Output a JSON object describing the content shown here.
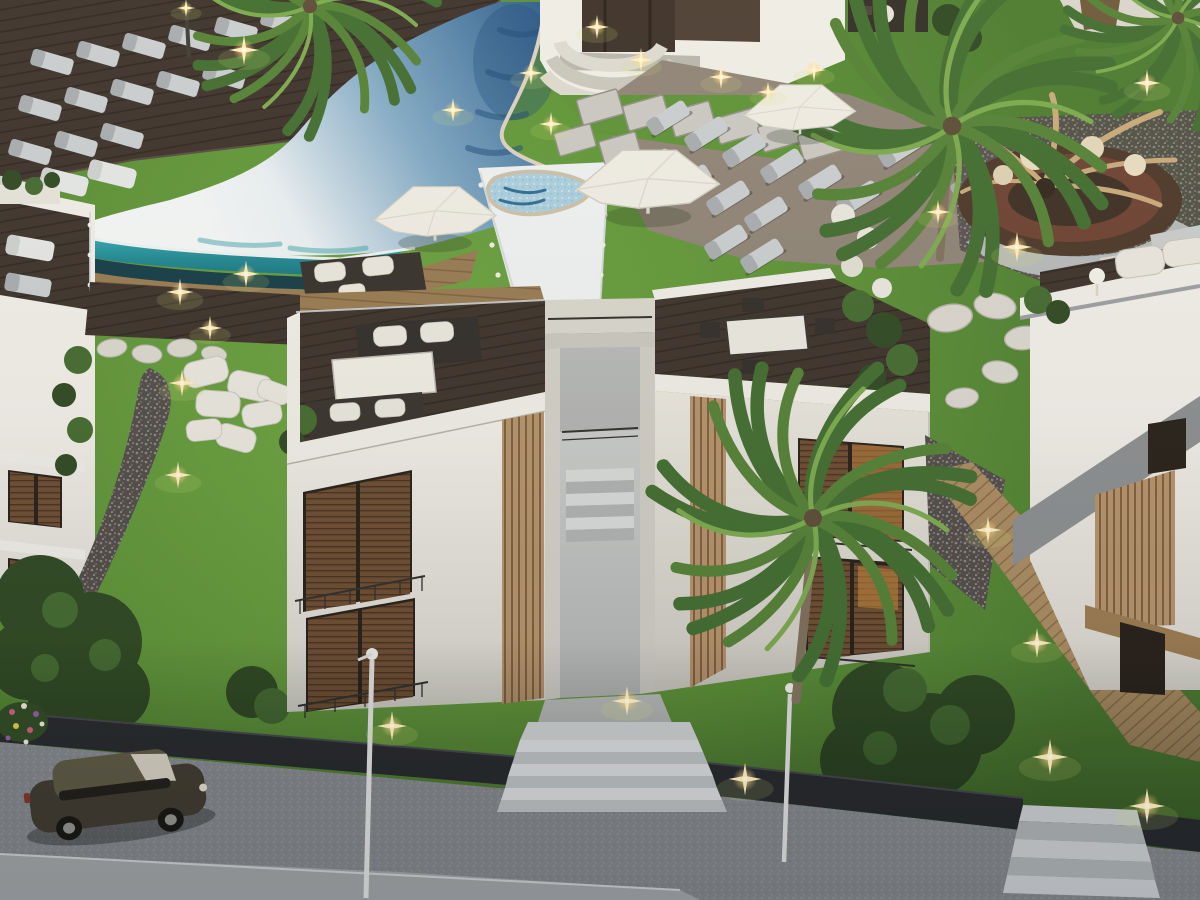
{
  "meta": {
    "title": "Aerial dusk render of a resort apartment complex with curved pool, rooftop terraces, gardens and street",
    "width": 1200,
    "height": 900,
    "image_type": "3d-architectural-render",
    "time_of_day": "dusk"
  },
  "palette": {
    "pool_deep": "#2b5c8c",
    "pool_mid": "#7fa8c4",
    "pool_light": "#e9eff2",
    "teal": "#35b3bb",
    "teal_dark": "#14707e",
    "wall_white": "#efede6",
    "wall_shade": "#d8d5cc",
    "wall_dim": "#c9c6bd",
    "window_dark": "#241d15",
    "warm_light": "#d08a3a",
    "railing": "#2e2c28",
    "paver": "#c9c7c0",
    "pool_deck": "#8d8274",
    "grass_hi": "#6da53f",
    "grass_lo": "#4a7a2c",
    "road": "#7e8184",
    "sidewalk": "#9b9e9f",
    "wall_dark": "#232527",
    "stair_light": "#d2d4d5",
    "stair_dark": "#b7babb",
    "fountain_ring": "#4a3526",
    "fountain_inner": "#6b4030",
    "driftwood": "#c8a878",
    "lantern_cream": "#e8dcc0",
    "palm_dark": "#3f6b2d",
    "palm_mid": "#527f33",
    "palm_light": "#7aa84b",
    "trunk": "#7d6e58",
    "bush": "#2c461f",
    "bush_hi": "#41682c",
    "car_body": "#3c372b",
    "car_roof": "#59543f",
    "glint": "#ffdf9e",
    "umbrella": "#efece3",
    "lounger": "#c9cdcf"
  },
  "scene": {
    "objects": [
      "swimming-pool",
      "infinity-edge",
      "pool-channel",
      "sun-deck",
      "sun-loungers",
      "parasols",
      "pool-house",
      "paver-path",
      "fountain-sculpture",
      "palm-trees",
      "left-apartment-building",
      "main-apartment-building",
      "rooftop-terraces",
      "central-stairwell",
      "right-villa",
      "pebble-stream",
      "cushion-lounge",
      "stepping-stones",
      "boardwalk",
      "retaining-wall",
      "street",
      "sidewalk",
      "entry-stairs",
      "parked-car",
      "street-lamps",
      "garden-lights",
      "flower-bed"
    ],
    "counts": {
      "buildings": 4,
      "palm_trees": 4,
      "parasols": 3,
      "sun_loungers": 34,
      "street_lamps": 2,
      "garden_lights": 24,
      "parked_cars": 1,
      "exterior_staircases": 2,
      "rooftop_terraces": 3
    }
  }
}
